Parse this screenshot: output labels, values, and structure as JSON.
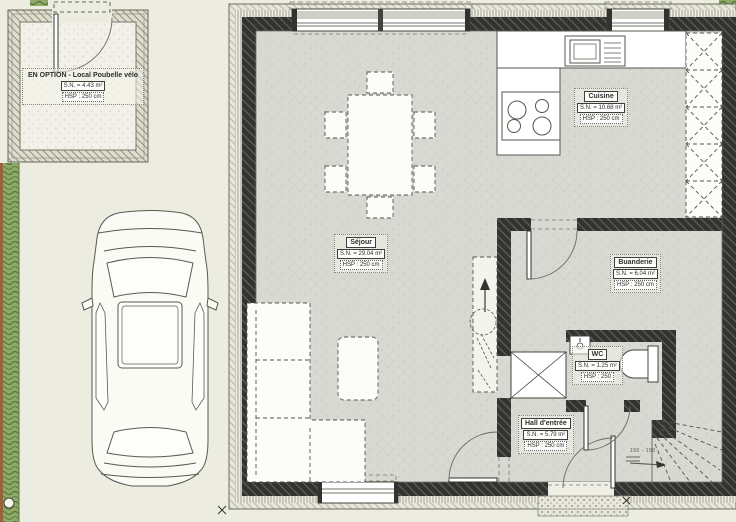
{
  "drawing": {
    "annex_label": {
      "title": "EN OPTION - Local Poubelle vélo",
      "area": "S.N. = 4.43 m²",
      "hsp": "HSP : 250 cm"
    },
    "rooms": {
      "sejour": {
        "name": "Séjour",
        "area": "S.N. = 29.04 m²",
        "hsp": "HSP : 250 cm"
      },
      "cuisine": {
        "name": "Cuisine",
        "area": "S.N. = 10.68 m²",
        "hsp": "HSP : 250 cm"
      },
      "buanderie": {
        "name": "Buanderie",
        "area": "S.N. = 6.04 m²",
        "hsp": "HSP : 250 cm"
      },
      "wc": {
        "name": "WC",
        "area": "S.N. = 1.25 m²",
        "hsp": "HSP : 250"
      },
      "hall": {
        "name": "Hall d'entrée",
        "area": "S.N. = 5.79 m²",
        "hsp": "HSP : 250 cm"
      }
    },
    "stairs_note": "150 - 150",
    "colors": {
      "page": "#ecede0",
      "wall": "#323230",
      "floor": "#d9d9d3",
      "hedge_green": "#8fa968",
      "hedge_brown": "#a65c38",
      "line": "#55554e"
    }
  }
}
